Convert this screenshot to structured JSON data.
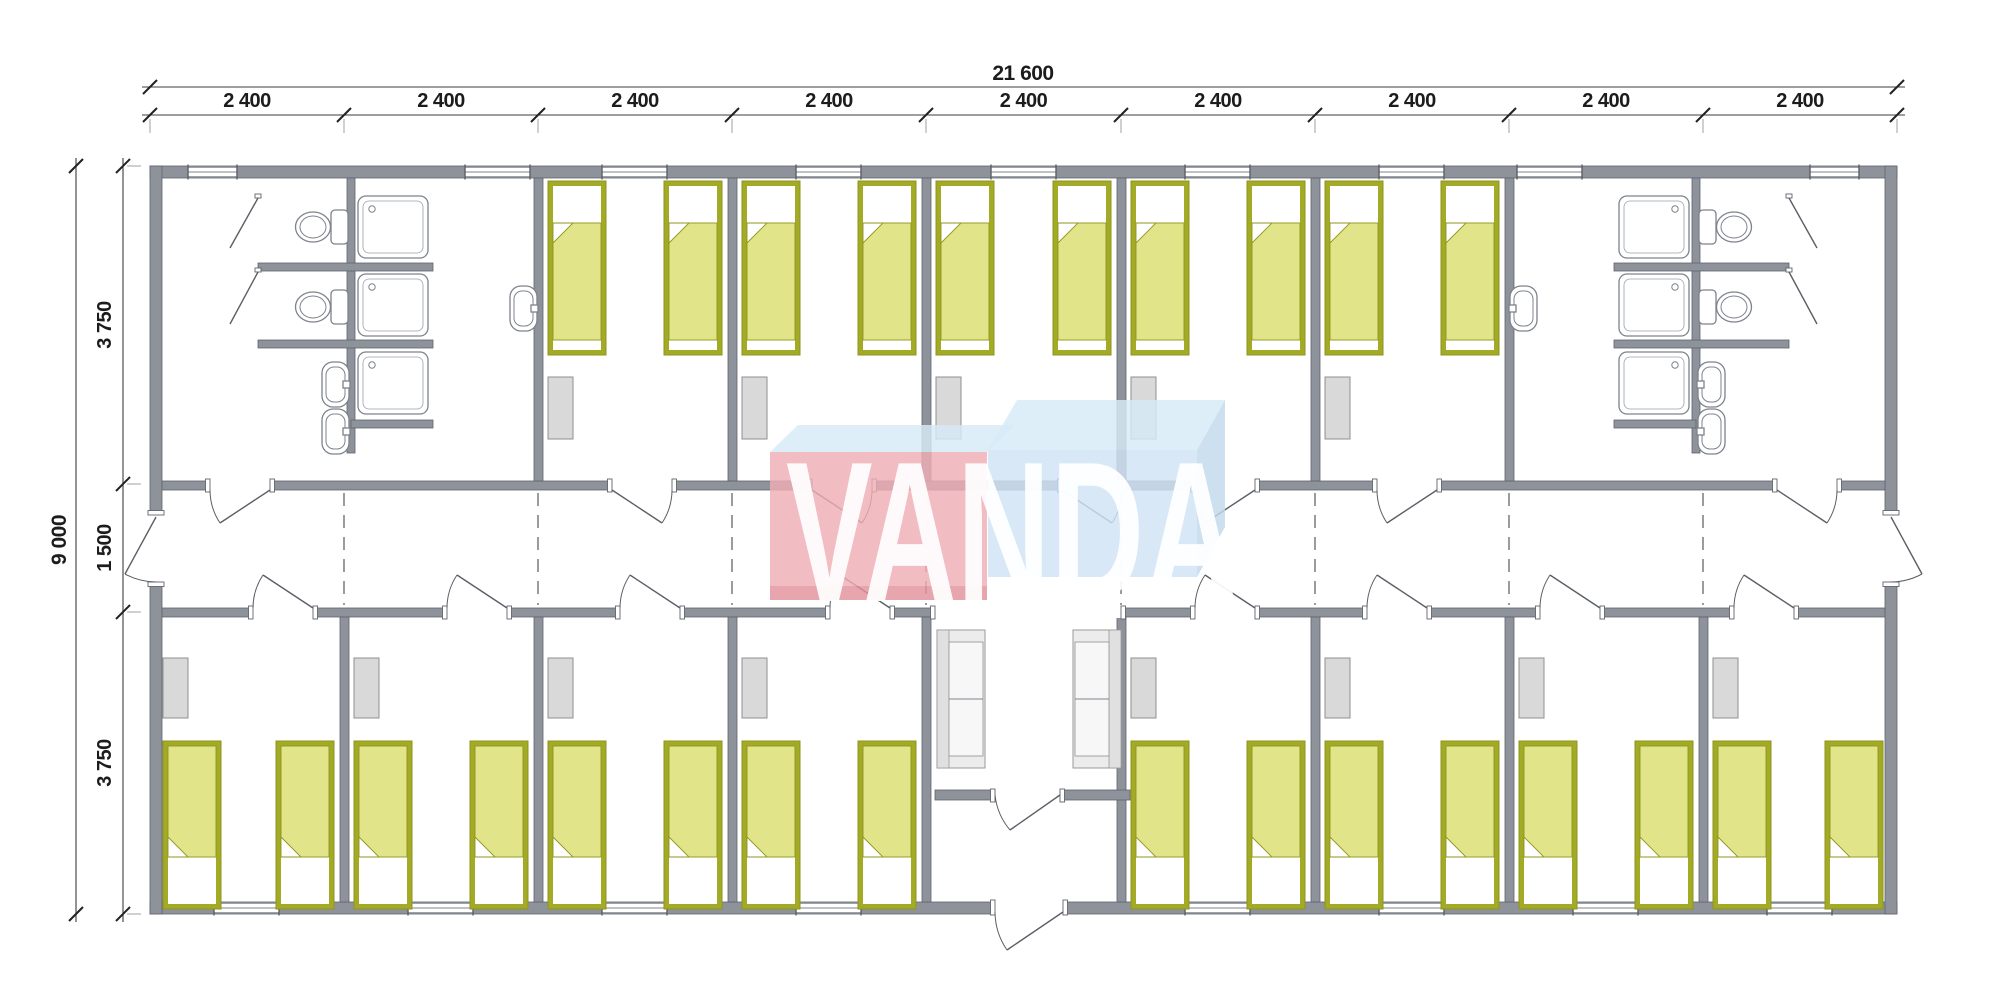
{
  "document": {
    "type": "modular-building-floor-plan",
    "units": "mm"
  },
  "dimensions": {
    "top_total": "21 600",
    "top_segments": [
      "2 400",
      "2 400",
      "2 400",
      "2 400",
      "2 400",
      "2 400",
      "2 400",
      "2 400",
      "2 400"
    ],
    "left_total": "9 000",
    "left_segments": [
      "3 750",
      "1 500",
      "3 750"
    ]
  },
  "watermark": {
    "text": "VANDA",
    "front_red": "#eeadb4",
    "red_shadow": "#e2939c",
    "front_blue": "#cfe3f4",
    "side_blue": "#c2d9ec",
    "top_face": "#d7eaf8",
    "letter_color": "#ffffff"
  },
  "colors": {
    "wall": "#8e939b",
    "bed_frame": "#a3aa26",
    "bed_blanket": "#e2e489",
    "bed_edge": "#8f951c",
    "furniture_gray": "#d9d9d9",
    "sofa_gray": "#ececec"
  },
  "inventory": {
    "bedrooms_top": 5,
    "bedrooms_bottom": 8,
    "beds": 26,
    "wardrobes": 13,
    "toilets": 4,
    "showers": 6,
    "washbasins": 6,
    "sofas": 2,
    "bathrooms": 2,
    "entrance_lobby": 1,
    "corridor_end_doors": 2
  },
  "plan": {
    "canvas": {
      "w": 2000,
      "h": 999
    },
    "building": {
      "x": 150,
      "y": 166,
      "w": 1747,
      "h": 748,
      "wall": 12
    },
    "corridor": {
      "wtopY": 481,
      "wbotY": 608,
      "wallT": 9,
      "lobbyGap": [
        935,
        1121
      ]
    },
    "dividers_top": [
      538,
      732,
      926,
      1121,
      1315,
      1509
    ],
    "dividers_bottom": [
      344,
      538,
      732,
      926,
      1121,
      1315,
      1509,
      1703
    ],
    "bath_center_walls": [
      {
        "x": 347
      },
      {
        "x": 1692
      }
    ],
    "stall_walls": [
      [
        258,
        263,
        175
      ],
      [
        258,
        340,
        175
      ],
      [
        1614,
        263,
        175
      ],
      [
        1614,
        340,
        175
      ]
    ],
    "shower_stubs": [
      [
        351,
        420,
        82
      ],
      [
        1614,
        420,
        82
      ]
    ],
    "lobby_partition": {
      "y": 790,
      "segs": [
        [
          935,
          60
        ],
        [
          1060,
          70
        ]
      ],
      "door": {
        "x": 995,
        "w": 65
      }
    },
    "entry_door": {
      "x": 995,
      "w": 68
    },
    "end_doors": {
      "openY": [
        515,
        582
      ]
    },
    "windows_top": [
      [
        188,
        49
      ],
      [
        465,
        65
      ],
      [
        602,
        65
      ],
      [
        796,
        65
      ],
      [
        991,
        65
      ],
      [
        1185,
        65
      ],
      [
        1379,
        65
      ],
      [
        1517,
        65
      ],
      [
        1810,
        49
      ]
    ],
    "windows_bottom": [
      [
        214,
        65
      ],
      [
        408,
        65
      ],
      [
        602,
        65
      ],
      [
        796,
        65
      ],
      [
        1185,
        65
      ],
      [
        1379,
        65
      ],
      [
        1573,
        65
      ],
      [
        1767,
        65
      ]
    ],
    "doors_top": [
      {
        "x": 210,
        "h": "R"
      },
      {
        "x": 612,
        "h": "L"
      },
      {
        "x": 812,
        "h": "L"
      },
      {
        "x": 1062,
        "h": "L"
      },
      {
        "x": 1195,
        "h": "R"
      },
      {
        "x": 1377,
        "h": "R"
      },
      {
        "x": 1777,
        "h": "L"
      }
    ],
    "doors_bottom": [
      {
        "x": 253
      },
      {
        "x": 447
      },
      {
        "x": 620
      },
      {
        "x": 830
      },
      {
        "x": 1195
      },
      {
        "x": 1367
      },
      {
        "x": 1540
      },
      {
        "x": 1734
      }
    ],
    "door_w": 60,
    "rooms_top": [
      [
        538,
        732
      ],
      [
        732,
        926
      ],
      [
        926,
        1121
      ],
      [
        1121,
        1315
      ],
      [
        1315,
        1509
      ]
    ],
    "rooms_bottom": [
      [
        150,
        344
      ],
      [
        344,
        538
      ],
      [
        538,
        732
      ],
      [
        732,
        926
      ],
      [
        1121,
        1315
      ],
      [
        1315,
        1509
      ],
      [
        1509,
        1703
      ],
      [
        1703,
        1897
      ]
    ],
    "bed": {
      "w": 58,
      "topY": 181,
      "topH": 174,
      "botY": 741,
      "botH": 168
    },
    "wardrobe": {
      "w": 25,
      "topY": 377,
      "topH": 62,
      "botY": 658,
      "botH": 60
    },
    "sofas": [
      {
        "x": 937,
        "y": 630,
        "w": 48,
        "h": 138,
        "back": "L"
      },
      {
        "x": 1073,
        "y": 630,
        "w": 48,
        "h": 138,
        "back": "R"
      }
    ],
    "showers": [
      {
        "x": 358,
        "ys": [
          196,
          274,
          352
        ],
        "h": 62,
        "drain": "L"
      },
      {
        "x": 1619,
        "ys": [
          196,
          274,
          352
        ],
        "h": 62,
        "drain": "R"
      }
    ],
    "toilets": [
      {
        "cy": 227,
        "side": "L"
      },
      {
        "cy": 307,
        "side": "L"
      },
      {
        "cy": 227,
        "side": "R"
      },
      {
        "cy": 307,
        "side": "R"
      }
    ],
    "sinks": [
      {
        "x": 322,
        "y": 362,
        "face": "L"
      },
      {
        "x": 322,
        "y": 409,
        "face": "L"
      },
      {
        "x": 510,
        "y": 286,
        "face": "L"
      },
      {
        "x": 1698,
        "y": 362,
        "face": "R"
      },
      {
        "x": 1698,
        "y": 409,
        "face": "R"
      },
      {
        "x": 1510,
        "y": 286,
        "face": "R"
      }
    ],
    "stall_door_leafs": [
      [
        258,
        198,
        230,
        248
      ],
      [
        258,
        272,
        230,
        324
      ],
      [
        1789,
        198,
        1817,
        248
      ],
      [
        1789,
        272,
        1817,
        324
      ]
    ],
    "dash_joints": [
      344,
      538,
      732,
      926,
      1121,
      1315,
      1509,
      1703
    ],
    "dims": {
      "topTotalY": 87,
      "topSegY": 115,
      "leftTotalX": 76,
      "leftSegX": 123,
      "bounds": [
        150,
        344,
        538,
        732,
        926,
        1121,
        1315,
        1509,
        1703,
        1897
      ],
      "vbounds": [
        166,
        484,
        612,
        914
      ]
    },
    "wm": {
      "redFront": [
        770,
        452,
        217,
        134
      ],
      "redShadow": [
        770,
        586,
        217,
        14
      ],
      "redTop": "770,452 987,452 1015,425 798,425",
      "blueTop": "988,450 1197,450 1225,400 1017,400",
      "blueFront": [
        988,
        450,
        209,
        127
      ],
      "blueSide": "1197,450 1225,400 1225,527 1197,577",
      "textX": 786,
      "textY": 601,
      "textLen": 452,
      "fontSize": 200
    }
  }
}
